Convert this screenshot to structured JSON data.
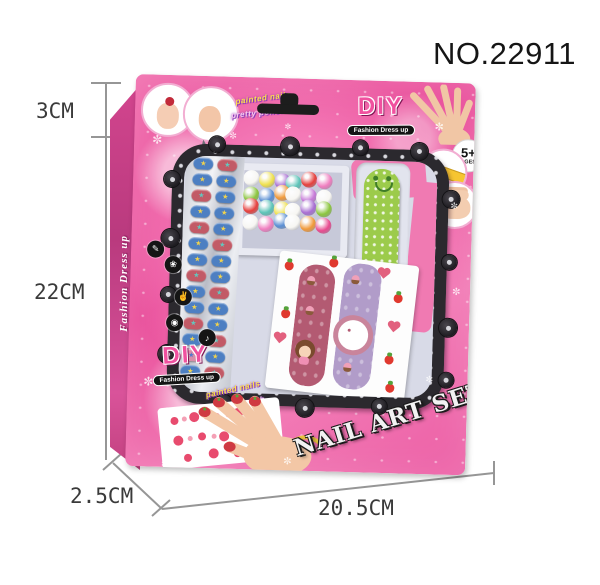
{
  "annotations": {
    "product_no": "NO.22911",
    "dim_top_height": "3CM",
    "dim_side_height": "22CM",
    "dim_depth": "2.5CM",
    "dim_width": "20.5CM"
  },
  "box": {
    "side_text": "Fashion Dress up",
    "logo": {
      "title": "DIY",
      "subtitle": "Fashion Dress up"
    },
    "banner_line1": "painted nails",
    "banner_line2": "pretty polish",
    "age_badge": {
      "value": "5+",
      "label": "AGES"
    },
    "star_letter": "X",
    "product_title": "NAIL ART SET",
    "sparkle_glyph": "✼",
    "icon_badges": [
      {
        "name": "nail-polish-icon",
        "glyph": "✎"
      },
      {
        "name": "flower-icon",
        "glyph": "❀"
      },
      {
        "name": "hand-icon",
        "glyph": "✌"
      },
      {
        "name": "disc-icon",
        "glyph": "◉"
      },
      {
        "name": "note-icon",
        "glyph": "♪"
      }
    ]
  },
  "contents": {
    "motif_glyph": "★",
    "bead_colors": [
      "#f7f6f2",
      "#efe14e",
      "#a96fd3",
      "#5cc4b8",
      "#e6403d",
      "#f07fc0",
      "#8cc63f",
      "#5b8fd4",
      "#f19a3a",
      "#f7f6f2",
      "#c779d8",
      "#f7f6f2",
      "#e6403d",
      "#5cc4b8",
      "#efe14e",
      "#f7f6f2",
      "#a96fd3",
      "#8cc63f",
      "#f7f6f2",
      "#f07fc0",
      "#5b8fd4",
      "#f7f6f2",
      "#f19a3a",
      "#e84b8f"
    ],
    "nail_chips": [
      {
        "c": "#4d7fc2",
        "m": "#f2d34c"
      },
      {
        "c": "#c25a66",
        "m": "#63c6bd"
      },
      {
        "c": "#4d7fc2",
        "m": "#f2d34c"
      },
      {
        "c": "#4d7fc2",
        "m": "#f2d34c"
      },
      {
        "c": "#c25a66",
        "m": "#63c6bd"
      },
      {
        "c": "#4d7fc2",
        "m": "#f2d34c"
      },
      {
        "c": "#4d7fc2",
        "m": "#f2d34c"
      },
      {
        "c": "#4d7fc2",
        "m": "#f2d34c"
      },
      {
        "c": "#c25a66",
        "m": "#63c6bd"
      },
      {
        "c": "#4d7fc2",
        "m": "#f2d34c"
      },
      {
        "c": "#4d7fc2",
        "m": "#f2d34c"
      },
      {
        "c": "#c25a66",
        "m": "#63c6bd"
      },
      {
        "c": "#4d7fc2",
        "m": "#f2d34c"
      },
      {
        "c": "#4d7fc2",
        "m": "#f2d34c"
      },
      {
        "c": "#c25a66",
        "m": "#63c6bd"
      },
      {
        "c": "#4d7fc2",
        "m": "#f2d34c"
      },
      {
        "c": "#4d7fc2",
        "m": "#f2d34c"
      },
      {
        "c": "#c25a66",
        "m": "#63c6bd"
      },
      {
        "c": "#4d7fc2",
        "m": "#f2d34c"
      },
      {
        "c": "#4d7fc2",
        "m": "#f2d34c"
      },
      {
        "c": "#c25a66",
        "m": "#63c6bd"
      },
      {
        "c": "#4d7fc2",
        "m": "#f2d34c"
      },
      {
        "c": "#4d7fc2",
        "m": "#f2d34c"
      },
      {
        "c": "#c25a66",
        "m": "#63c6bd"
      },
      {
        "c": "#d88da8",
        "m": "#5577cc"
      },
      {
        "c": "#4d7fc2",
        "m": "#f2d34c"
      },
      {
        "c": "#4d7fc2",
        "m": "#f2d34c"
      },
      {
        "c": "#c25a66",
        "m": "#63c6bd"
      }
    ]
  },
  "colors": {
    "box_pink": "#ee61a7",
    "side_pink": "#c93f86",
    "frame_dark": "#2b292e",
    "tray_lavender": "#d8dae7",
    "file_green": "#9ccb4b",
    "logo_pink": "#f0519f",
    "annotation_line": "#969696"
  }
}
